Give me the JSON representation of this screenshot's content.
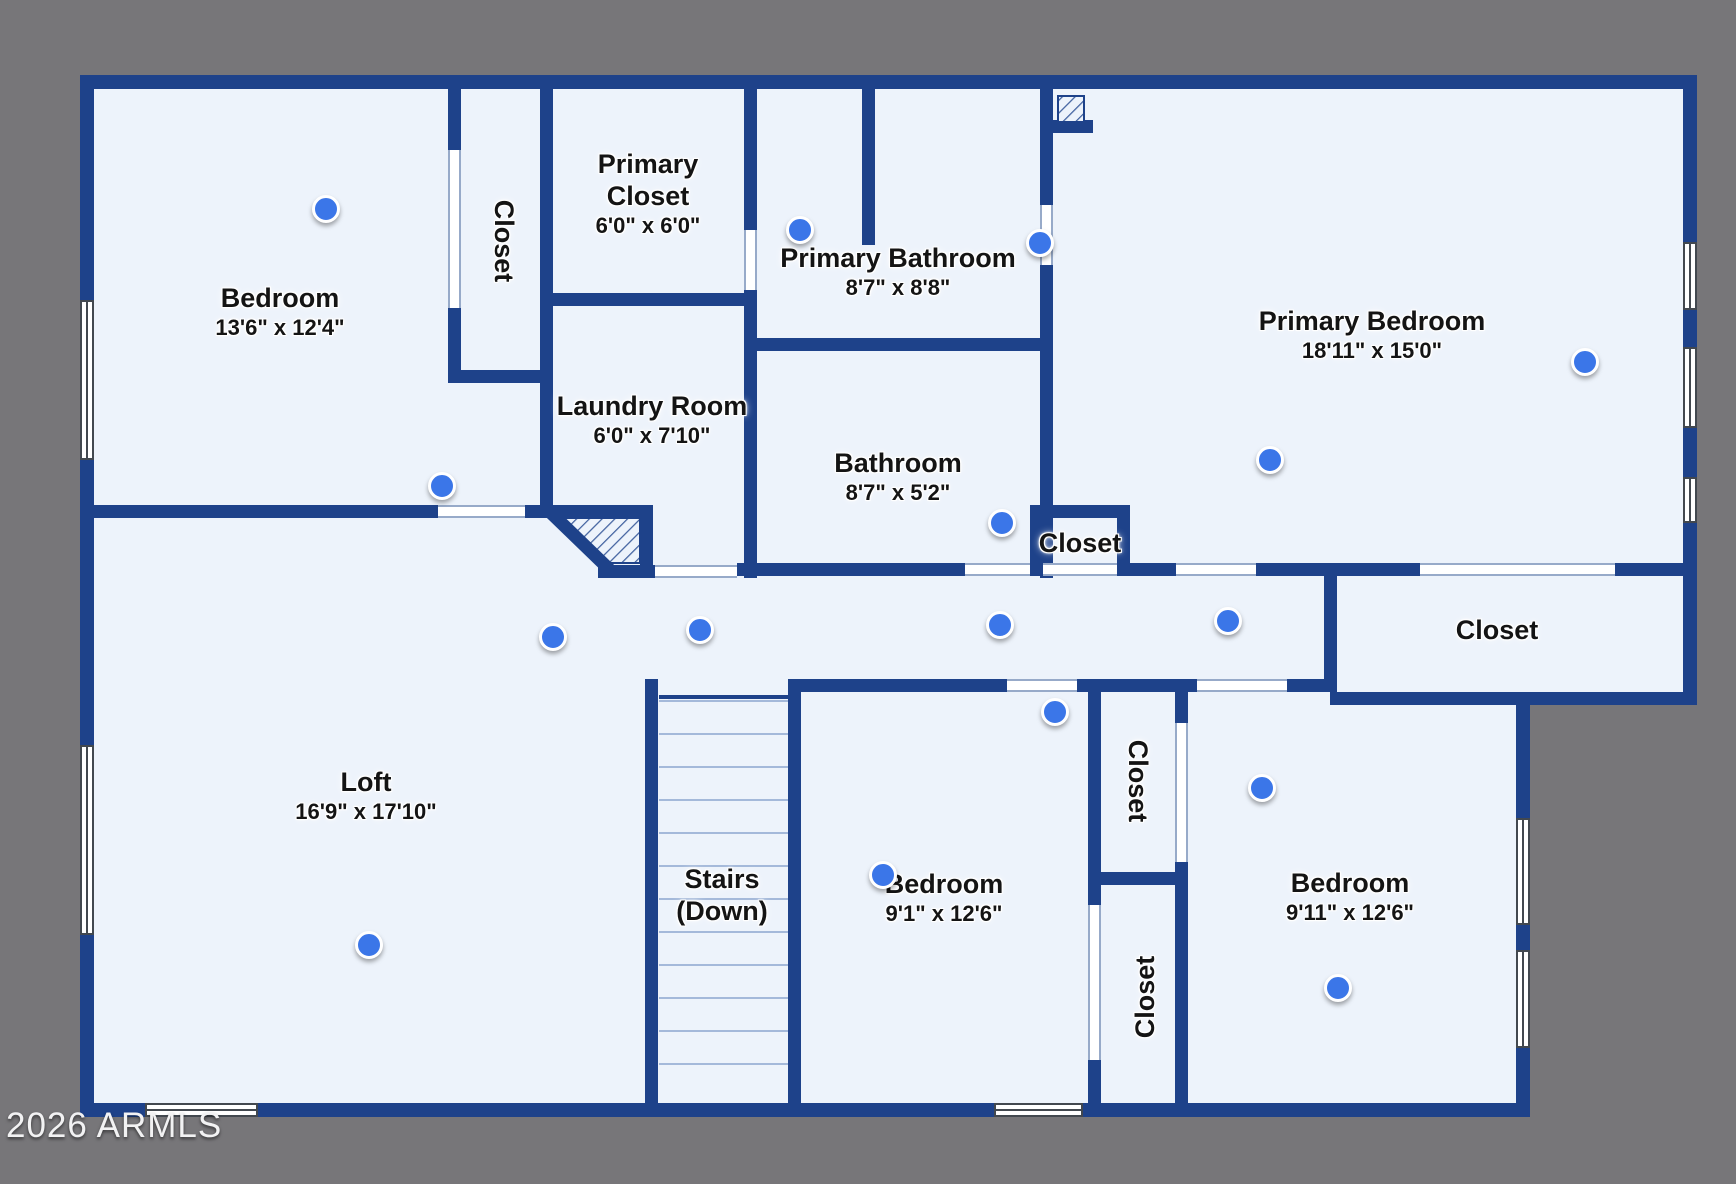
{
  "watermark": "2026 ARMLS",
  "colors": {
    "background_gray": "#777679",
    "wall_blue": "#1e428a",
    "floor": "#edf3fb",
    "dot_blue": "#3b76e8",
    "hatch_line": "#41619f",
    "tread_line": "#a4b9da"
  },
  "rooms": [
    {
      "id": "bedroom-nw",
      "name_lines": [
        "Bedroom"
      ],
      "dims": "13'6\" x 12'4\"",
      "x": 280,
      "y": 312,
      "rotate": 0
    },
    {
      "id": "closet-nw",
      "name_lines": [
        "Closet"
      ],
      "dims": "",
      "x": 503,
      "y": 241,
      "rotate": 90
    },
    {
      "id": "primary-closet",
      "name_lines": [
        "Primary",
        "Closet"
      ],
      "dims": "6'0\" x 6'0\"",
      "x": 648,
      "y": 194,
      "rotate": 0
    },
    {
      "id": "primary-bathroom",
      "name_lines": [
        "Primary Bathroom"
      ],
      "dims": "8'7\" x 8'8\"",
      "x": 898,
      "y": 272,
      "rotate": 0
    },
    {
      "id": "primary-bedroom",
      "name_lines": [
        "Primary Bedroom"
      ],
      "dims": "18'11\" x 15'0\"",
      "x": 1372,
      "y": 335,
      "rotate": 0
    },
    {
      "id": "laundry-room",
      "name_lines": [
        "Laundry Room"
      ],
      "dims": "6'0\" x 7'10\"",
      "x": 652,
      "y": 420,
      "rotate": 0
    },
    {
      "id": "bathroom",
      "name_lines": [
        "Bathroom"
      ],
      "dims": "8'7\" x 5'2\"",
      "x": 898,
      "y": 477,
      "rotate": 0
    },
    {
      "id": "closet-bathroom",
      "name_lines": [
        "Closet"
      ],
      "dims": "",
      "x": 1080,
      "y": 544,
      "rotate": 0
    },
    {
      "id": "closet-right",
      "name_lines": [
        "Closet"
      ],
      "dims": "",
      "x": 1497,
      "y": 631,
      "rotate": 0
    },
    {
      "id": "loft",
      "name_lines": [
        "Loft"
      ],
      "dims": "16'9\" x 17'10\"",
      "x": 366,
      "y": 796,
      "rotate": 0
    },
    {
      "id": "stairs",
      "name_lines": [
        "Stairs",
        "(Down)"
      ],
      "dims": "",
      "x": 722,
      "y": 896,
      "rotate": 0
    },
    {
      "id": "bedroom-s",
      "name_lines": [
        "Bedroom"
      ],
      "dims": "9'1\" x 12'6\"",
      "x": 944,
      "y": 898,
      "rotate": 0
    },
    {
      "id": "closet-mid-upper",
      "name_lines": [
        "Closet"
      ],
      "dims": "",
      "x": 1137,
      "y": 781,
      "rotate": 90
    },
    {
      "id": "closet-mid-lower",
      "name_lines": [
        "Closet"
      ],
      "dims": "",
      "x": 1146,
      "y": 997,
      "rotate": -90
    },
    {
      "id": "bedroom-se",
      "name_lines": [
        "Bedroom"
      ],
      "dims": "9'11\" x 12'6\"",
      "x": 1350,
      "y": 897,
      "rotate": 0
    }
  ],
  "dots": [
    {
      "x": 326,
      "y": 209
    },
    {
      "x": 800,
      "y": 230
    },
    {
      "x": 1040,
      "y": 243
    },
    {
      "x": 1585,
      "y": 362
    },
    {
      "x": 1270,
      "y": 460
    },
    {
      "x": 442,
      "y": 486
    },
    {
      "x": 1002,
      "y": 523
    },
    {
      "x": 553,
      "y": 637
    },
    {
      "x": 700,
      "y": 630
    },
    {
      "x": 1000,
      "y": 625
    },
    {
      "x": 1228,
      "y": 621
    },
    {
      "x": 1055,
      "y": 712
    },
    {
      "x": 883,
      "y": 875
    },
    {
      "x": 369,
      "y": 945
    },
    {
      "x": 1262,
      "y": 788
    },
    {
      "x": 1338,
      "y": 988
    }
  ],
  "floorplan": {
    "floor_rects": [
      [
        94,
        89,
        1589,
        603
      ],
      [
        94,
        89,
        1422,
        1014
      ]
    ],
    "walls": [
      [
        80,
        75,
        1617,
        14
      ],
      [
        80,
        75,
        14,
        1042
      ],
      [
        80,
        1103,
        1450,
        14
      ],
      [
        1683,
        75,
        14,
        630
      ],
      [
        1516,
        692,
        14,
        425
      ],
      [
        1330,
        692,
        367,
        13
      ],
      [
        448,
        88,
        13,
        62
      ],
      [
        448,
        308,
        13,
        75
      ],
      [
        448,
        370,
        105,
        13
      ],
      [
        540,
        88,
        13,
        430
      ],
      [
        552,
        293,
        205,
        13
      ],
      [
        744,
        88,
        13,
        142
      ],
      [
        744,
        290,
        13,
        288
      ],
      [
        862,
        88,
        13,
        157
      ],
      [
        1040,
        88,
        13,
        117
      ],
      [
        1040,
        265,
        13,
        313
      ],
      [
        1046,
        120,
        47,
        13
      ],
      [
        744,
        338,
        309,
        13
      ],
      [
        1030,
        505,
        100,
        13
      ],
      [
        1030,
        505,
        13,
        71
      ],
      [
        1117,
        505,
        13,
        71
      ],
      [
        737,
        563,
        228,
        13
      ],
      [
        1130,
        563,
        46,
        13
      ],
      [
        1256,
        563,
        164,
        13
      ],
      [
        1615,
        563,
        82,
        13
      ],
      [
        1324,
        576,
        13,
        116
      ],
      [
        94,
        505,
        344,
        13
      ],
      [
        525,
        505,
        128,
        13
      ],
      [
        640,
        505,
        13,
        73
      ],
      [
        598,
        565,
        57,
        13
      ],
      [
        645,
        679,
        13,
        424
      ],
      [
        788,
        679,
        13,
        424
      ],
      [
        801,
        679,
        206,
        13
      ],
      [
        1077,
        679,
        120,
        13
      ],
      [
        1287,
        679,
        43,
        13
      ],
      [
        1088,
        679,
        13,
        226
      ],
      [
        1088,
        1060,
        13,
        43
      ],
      [
        1175,
        679,
        13,
        44
      ],
      [
        1175,
        862,
        13,
        241
      ],
      [
        1088,
        872,
        100,
        13
      ]
    ],
    "doors": [
      [
        448,
        150,
        13,
        158
      ],
      [
        438,
        505,
        87,
        13
      ],
      [
        744,
        230,
        13,
        60
      ],
      [
        1040,
        205,
        13,
        60
      ],
      [
        655,
        565,
        82,
        13
      ],
      [
        965,
        563,
        65,
        13
      ],
      [
        1043,
        563,
        74,
        13
      ],
      [
        1176,
        563,
        80,
        13
      ],
      [
        1420,
        563,
        195,
        13
      ],
      [
        1007,
        679,
        70,
        13
      ],
      [
        1197,
        679,
        90,
        13
      ],
      [
        1175,
        723,
        13,
        139
      ],
      [
        1088,
        905,
        13,
        155
      ]
    ],
    "windows": [
      [
        80,
        300,
        14,
        160
      ],
      [
        80,
        745,
        14,
        190
      ],
      [
        145,
        1103,
        113,
        14
      ],
      [
        994,
        1103,
        89,
        14
      ],
      [
        1683,
        242,
        14,
        68
      ],
      [
        1683,
        347,
        14,
        81
      ],
      [
        1683,
        477,
        14,
        46
      ],
      [
        1516,
        818,
        14,
        107
      ],
      [
        1516,
        950,
        14,
        98
      ]
    ],
    "stairs": {
      "x": 659,
      "width": 129,
      "tread_y_start": 700,
      "tread_step": 33,
      "tread_count": 12,
      "entry_edge": [
        659,
        695,
        129,
        4
      ]
    },
    "hatch_square": [
      1058,
      96,
      26,
      26
    ],
    "hatch_quad_points": "556,518 640,518 640,563 605,563",
    "diag_wall": {
      "x1": 549,
      "y1": 511,
      "x2": 611,
      "y2": 571,
      "width": 13
    }
  }
}
